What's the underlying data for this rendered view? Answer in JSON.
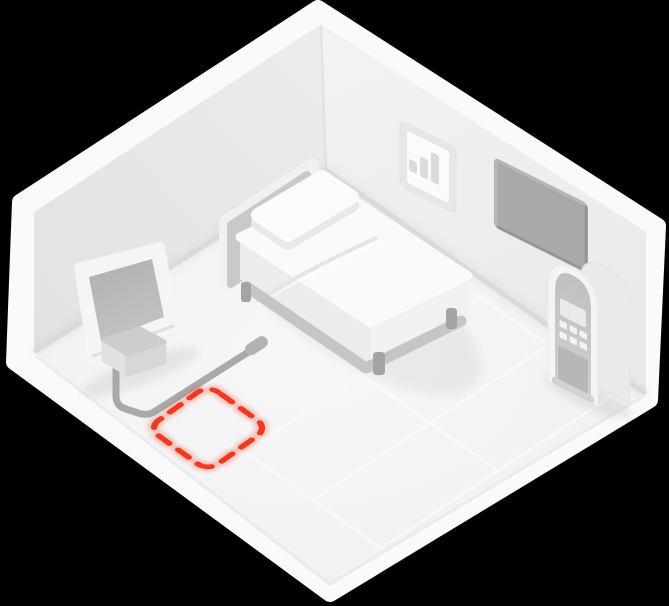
{
  "scene": {
    "title": "isometric-bedroom-placement-illustration",
    "background_color": "#000000",
    "accent_color": "#EE3A21",
    "room": {
      "left_wall_color": "#E7E7E9",
      "right_wall_color": "#EFEFF1",
      "floor_color": "#F4F4F6",
      "rim_color": "#FAFAFC",
      "baseboard_color": "#D7D9DB",
      "seam_color": "#DEE0E2"
    },
    "objects": {
      "bed": {
        "label": "bed",
        "parts": [
          "headboard",
          "pillow",
          "mattress",
          "duvet-fold",
          "frame-rail",
          "legs"
        ],
        "mattress_color": "#FAFAFC",
        "headboard_panel_color": "#C7C9CB",
        "leg_color": "#A2A4A6"
      },
      "tv": {
        "label": "television",
        "screen_color": "#B7B9BB",
        "frame_color": "#F5F5F7"
      },
      "media_box": {
        "label": "media-box",
        "top_color": "#CBCDCF"
      },
      "cable": {
        "label": "power-cable",
        "color": "#A7A9AB"
      },
      "wall_art": {
        "label": "bar-chart-picture",
        "icon": "bar-chart-icon",
        "frame_color": "#E7E7E9",
        "bar_color": "#D9DBDD",
        "bars": 3
      },
      "wall_panel": {
        "label": "dark-wall-panel",
        "color": "#A7A9AB"
      },
      "arch_cabinet": {
        "label": "arched-control-cabinet",
        "parts": [
          "display-screen",
          "keypad-buttons",
          "lower-panel"
        ],
        "keypad": {
          "rows": 2,
          "cols": 3
        },
        "recess_color": "#C5C7C9"
      },
      "placement_marker": {
        "label": "suggested-device-placement",
        "style": "dashed-rounded-square",
        "color": "#EE3A21"
      },
      "floor_tiles": {
        "label": "floor-tile-grid",
        "rows": 2,
        "cols": 2,
        "line_color": "#FFFFFF"
      }
    }
  }
}
